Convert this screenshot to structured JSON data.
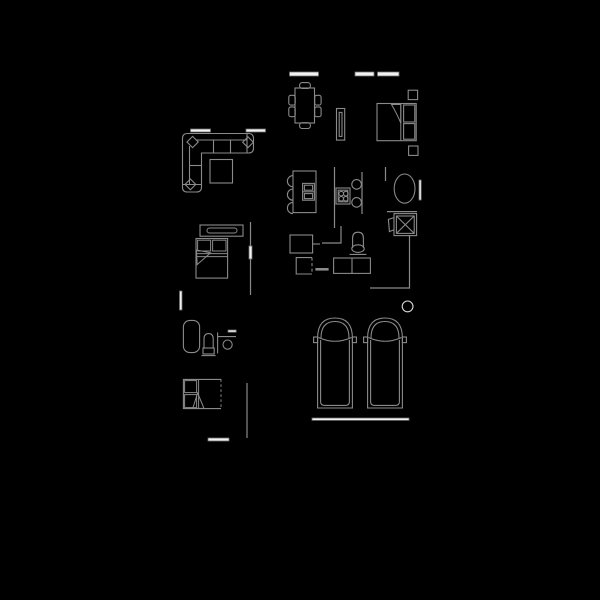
{
  "scene": {
    "kind": "architectural-floor-plan",
    "background_color": "#000000",
    "line_color": "#8a8a8a",
    "window_color": "#f2f2f2",
    "column_color": "#d8d8d8",
    "items": [
      {
        "name": "dining-table",
        "chairs": 6
      },
      {
        "name": "console-cabinet"
      },
      {
        "name": "master-bed",
        "pillows": 2,
        "nightstands": 2
      },
      {
        "name": "sectional-sofa",
        "corner_cushions": 3
      },
      {
        "name": "coffee-table"
      },
      {
        "name": "kitchen-island",
        "stools": 3,
        "sink_basins": 2
      },
      {
        "name": "cooktop",
        "burners": 4
      },
      {
        "name": "counter-seats",
        "count": 2
      },
      {
        "name": "oval-basin"
      },
      {
        "name": "washing-machine"
      },
      {
        "name": "toilet",
        "count": 2
      },
      {
        "name": "base-cabinet",
        "count": 3
      },
      {
        "name": "dresser"
      },
      {
        "name": "double-bed-second"
      },
      {
        "name": "bathtub"
      },
      {
        "name": "vanity-round-sink"
      },
      {
        "name": "single-bed"
      },
      {
        "name": "car",
        "count": 2
      },
      {
        "name": "structural-column"
      },
      {
        "name": "garage-door"
      },
      {
        "name": "window",
        "count": 9
      }
    ]
  }
}
